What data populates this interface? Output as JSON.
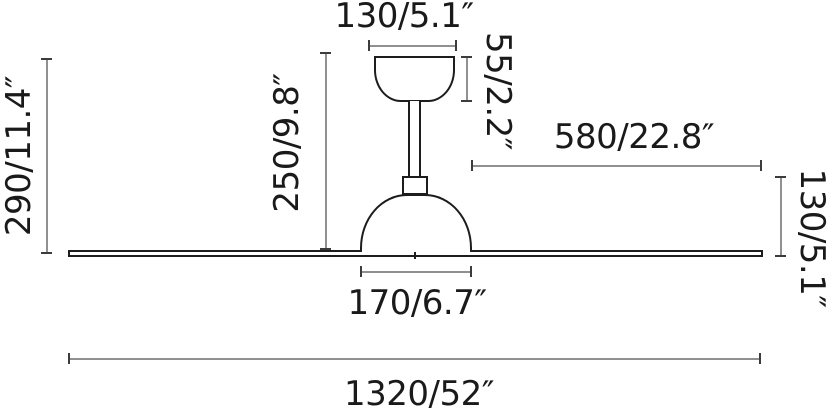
{
  "diagram": {
    "type": "ceiling-fan dimension drawing",
    "unit_format": "millimetres/inches",
    "labels": {
      "canopy_width": "130/5.1″",
      "canopy_height": "55/2.2″",
      "total_height": "290/11.4″",
      "rod_height": "250/9.8″",
      "blade_length": "580/22.8″",
      "motor_height": "130/5.1″",
      "motor_width": "170/6.7″",
      "total_diameter": "1320/52″"
    },
    "colors": {
      "outline": "#1d1d1d",
      "dimension_line": "#909090",
      "text": "#1a1a1a",
      "background": "#ffffff"
    }
  }
}
